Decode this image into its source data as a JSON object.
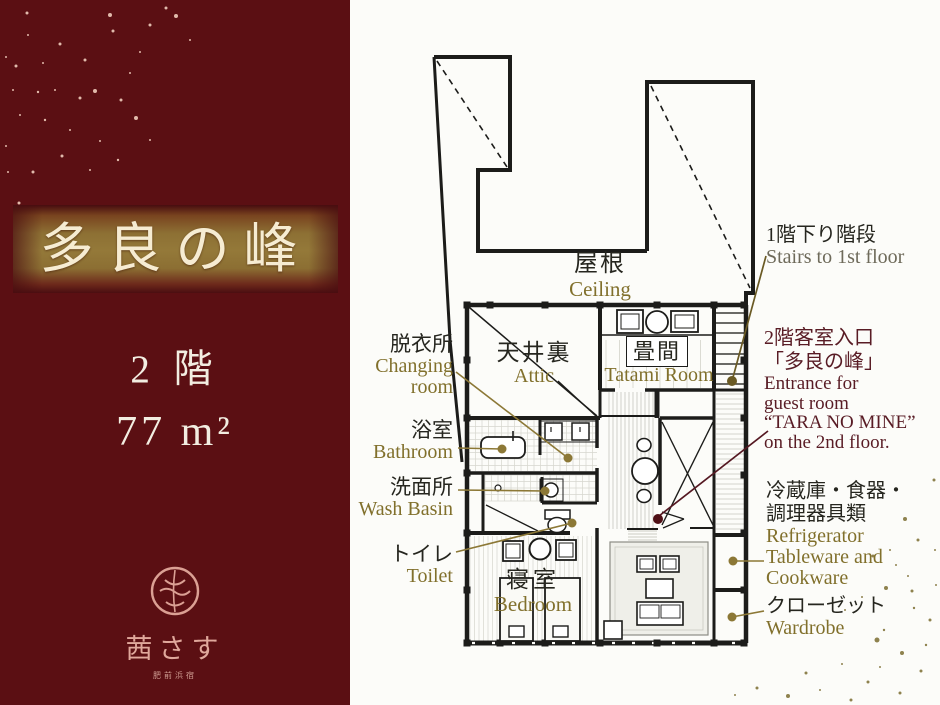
{
  "left_panel": {
    "title": "多良の峰",
    "floor": "2 階",
    "area": "77 m²",
    "logo_text": "茜さす",
    "logo_subtext": "肥前浜宿"
  },
  "plan": {
    "roof": {
      "jp": "屋根",
      "en": "Ceiling"
    },
    "attic": {
      "jp": "天井裏",
      "en": "Attic"
    },
    "tatami": {
      "jp": "畳間",
      "en": "Tatami Room"
    },
    "changing": {
      "jp": "脱衣所",
      "en": "Changing\nroom"
    },
    "bathroom": {
      "jp": "浴室",
      "en": "Bathroom"
    },
    "washbasin": {
      "jp": "洗面所",
      "en": "Wash Basin"
    },
    "toilet": {
      "jp": "トイレ",
      "en": "Toilet"
    },
    "bedroom": {
      "jp": "寝室",
      "en": "Bedroom"
    },
    "stairs": {
      "jp": "1階下り階段",
      "en": "Stairs to 1st floor"
    },
    "entrance": {
      "jp_line1": "2階客室入口",
      "jp_line2": "「多良の峰」",
      "en": "Entrance for\nguest room\n“TARA NO MINE”\non the 2nd floor."
    },
    "kitchenware": {
      "jp": "冷蔵庫・食器・\n調理器具類",
      "en": "Refrigerator\nTableware and\nCookware"
    },
    "wardrobe": {
      "jp": "クローゼット",
      "en": "Wardrobe"
    }
  },
  "colors": {
    "panel_maroon": "#5b0f13",
    "band_gold": "#8d7034",
    "title_cream": "#f6ecd2",
    "label_olive": "#81702c",
    "label_maroon": "#591c25",
    "leader_olive": "#8c7836",
    "stairs_leader": "#6a5a24",
    "entrance_leader": "#551822",
    "wall_black": "#1c1c1a",
    "logo_pink": "#dba094"
  }
}
